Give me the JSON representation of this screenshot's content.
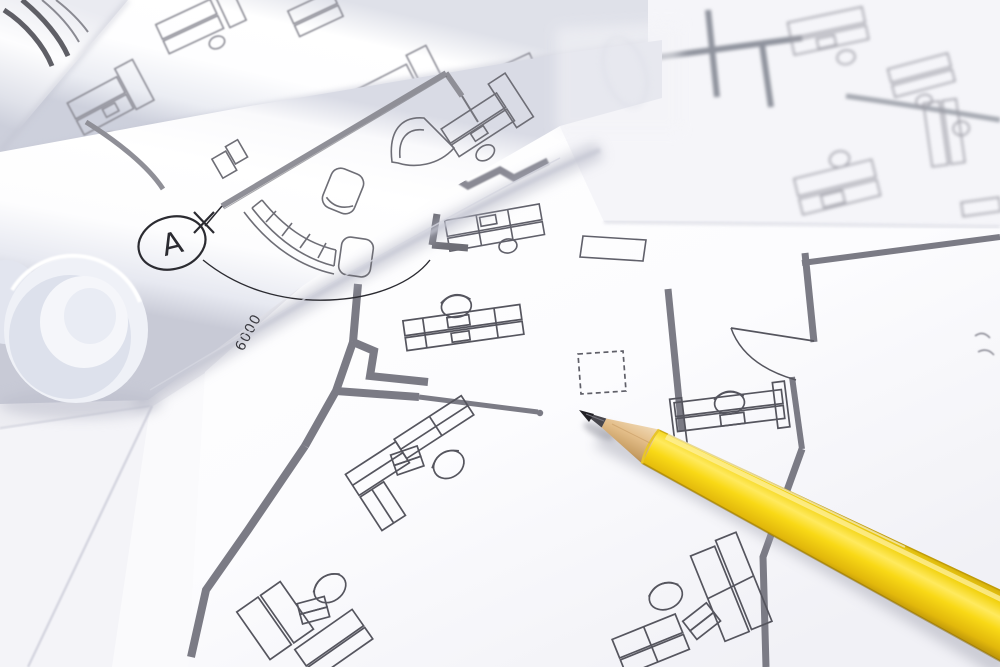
{
  "scene": {
    "description": "Photograph of architectural blueprint floor plans: rolled drawing sheets at top left, flat office floor-plan sheets with furniture symbols, and a sharpened yellow pencil lying across the plans pointing at a wall line",
    "annotations": {
      "section_marker_label": "A",
      "dimension_text": "6000"
    },
    "objects": [
      "blueprint-roll-striped",
      "blueprint-roll-middle",
      "blueprint-roll-foreground",
      "roll-open-end",
      "background-plan-sheet",
      "center-plan-sheet",
      "underlying-sheets",
      "yellow-pencil"
    ],
    "plan_symbols": [
      "section-marker-circle",
      "dimension-label",
      "curved-sofa",
      "armchairs",
      "grand-piano-shape",
      "workstation-desks-with-chairs",
      "laptop-symbols",
      "meeting-table",
      "dashed-equipment-box",
      "door-swing-arc",
      "thick-partition-walls"
    ],
    "colors": {
      "table_surface": "#ededf2",
      "paper_white": "#ffffff",
      "paper_shadow": "#c9cbd8",
      "plan_line_thin": "#5b5b64",
      "plan_wall_gray": "#7d7d87",
      "marker_ink": "#2b2b31",
      "pencil_body_yellow": "#f7d816",
      "pencil_highlight": "#ffee73",
      "pencil_body_dark": "#c79e0a",
      "pencil_wood": "#e3bd88",
      "pencil_graphite": "#47464c",
      "pencil_tip_black": "#222126"
    }
  }
}
